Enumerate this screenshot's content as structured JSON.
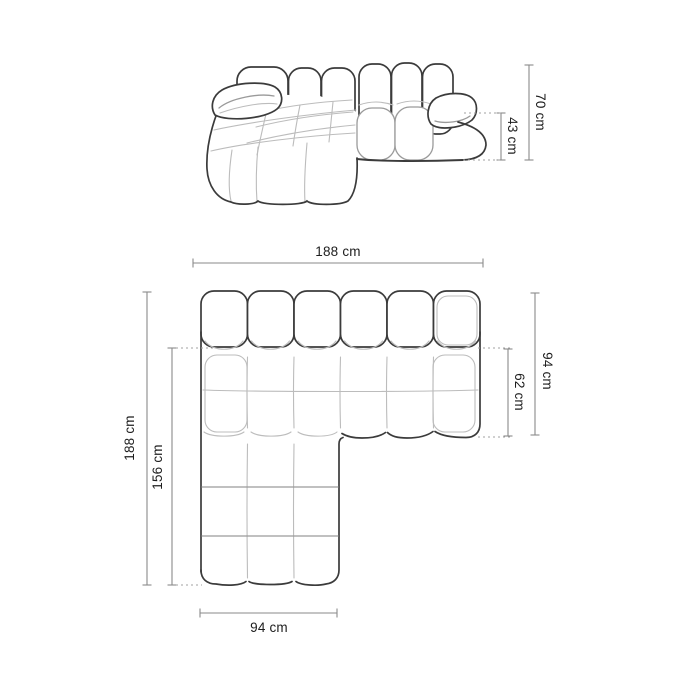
{
  "front_view": {
    "dimensions": [
      {
        "name": "total-height",
        "value": "70 cm"
      },
      {
        "name": "seat-height",
        "value": "43 cm"
      }
    ]
  },
  "top_view": {
    "dimensions": [
      {
        "name": "total-width",
        "value": "188 cm"
      },
      {
        "name": "side-depth",
        "value": "94 cm"
      },
      {
        "name": "seat-depth",
        "value": "62 cm"
      },
      {
        "name": "total-depth",
        "value": "188 cm"
      },
      {
        "name": "chaise-depth",
        "value": "156 cm"
      },
      {
        "name": "chaise-width",
        "value": "94 cm"
      }
    ]
  },
  "colors": {
    "background": "#ffffff",
    "outline": "#3b3b3b",
    "inner_line": "#bcbcbc",
    "dimension_line": "#8a8a8a",
    "label_text": "#1d1d1d"
  }
}
